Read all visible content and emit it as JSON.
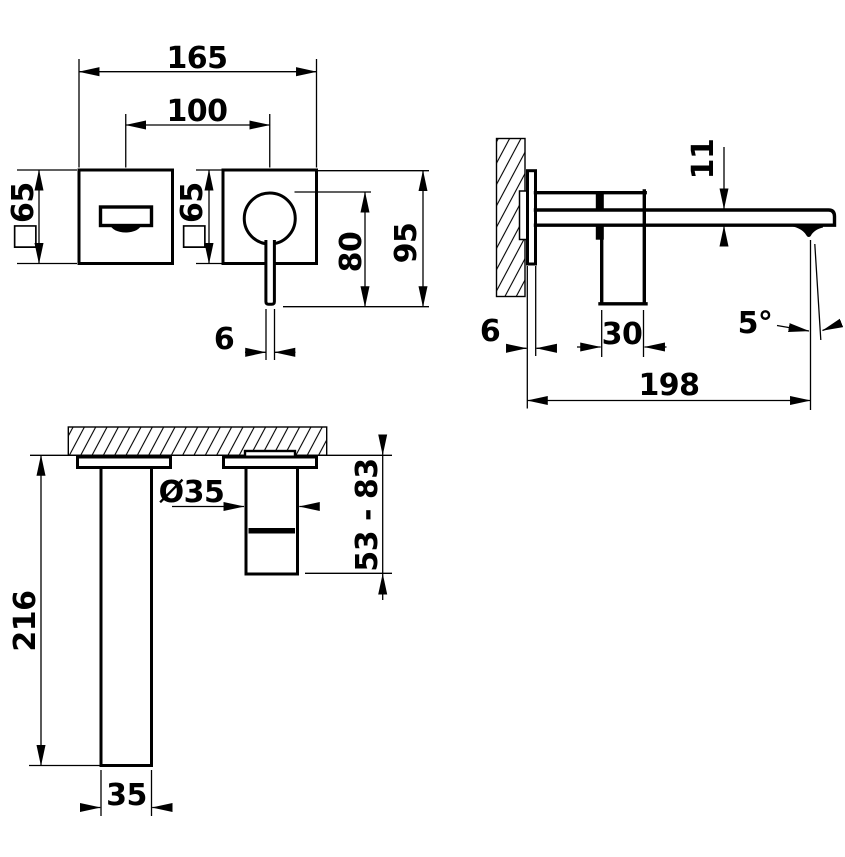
{
  "colors": {
    "ink": "#000000",
    "paper": "#ffffff"
  },
  "views": {
    "front": {
      "overall_width": "165",
      "centers_distance": "100",
      "spout_plate_size": "□65",
      "handle_plate_size": "□65",
      "lever_length": "80",
      "overall_height": "95",
      "lever_width": "6"
    },
    "side": {
      "spout_height": "11",
      "plate_thickness": "6",
      "handle_body_width": "30",
      "spout_angle": "5°",
      "spout_reach": "198"
    },
    "installation": {
      "valve_diameter": "Ø35",
      "adjustable_depth_range": "53 - 83",
      "concealed_body_length": "216",
      "concealed_body_width": "35"
    }
  }
}
